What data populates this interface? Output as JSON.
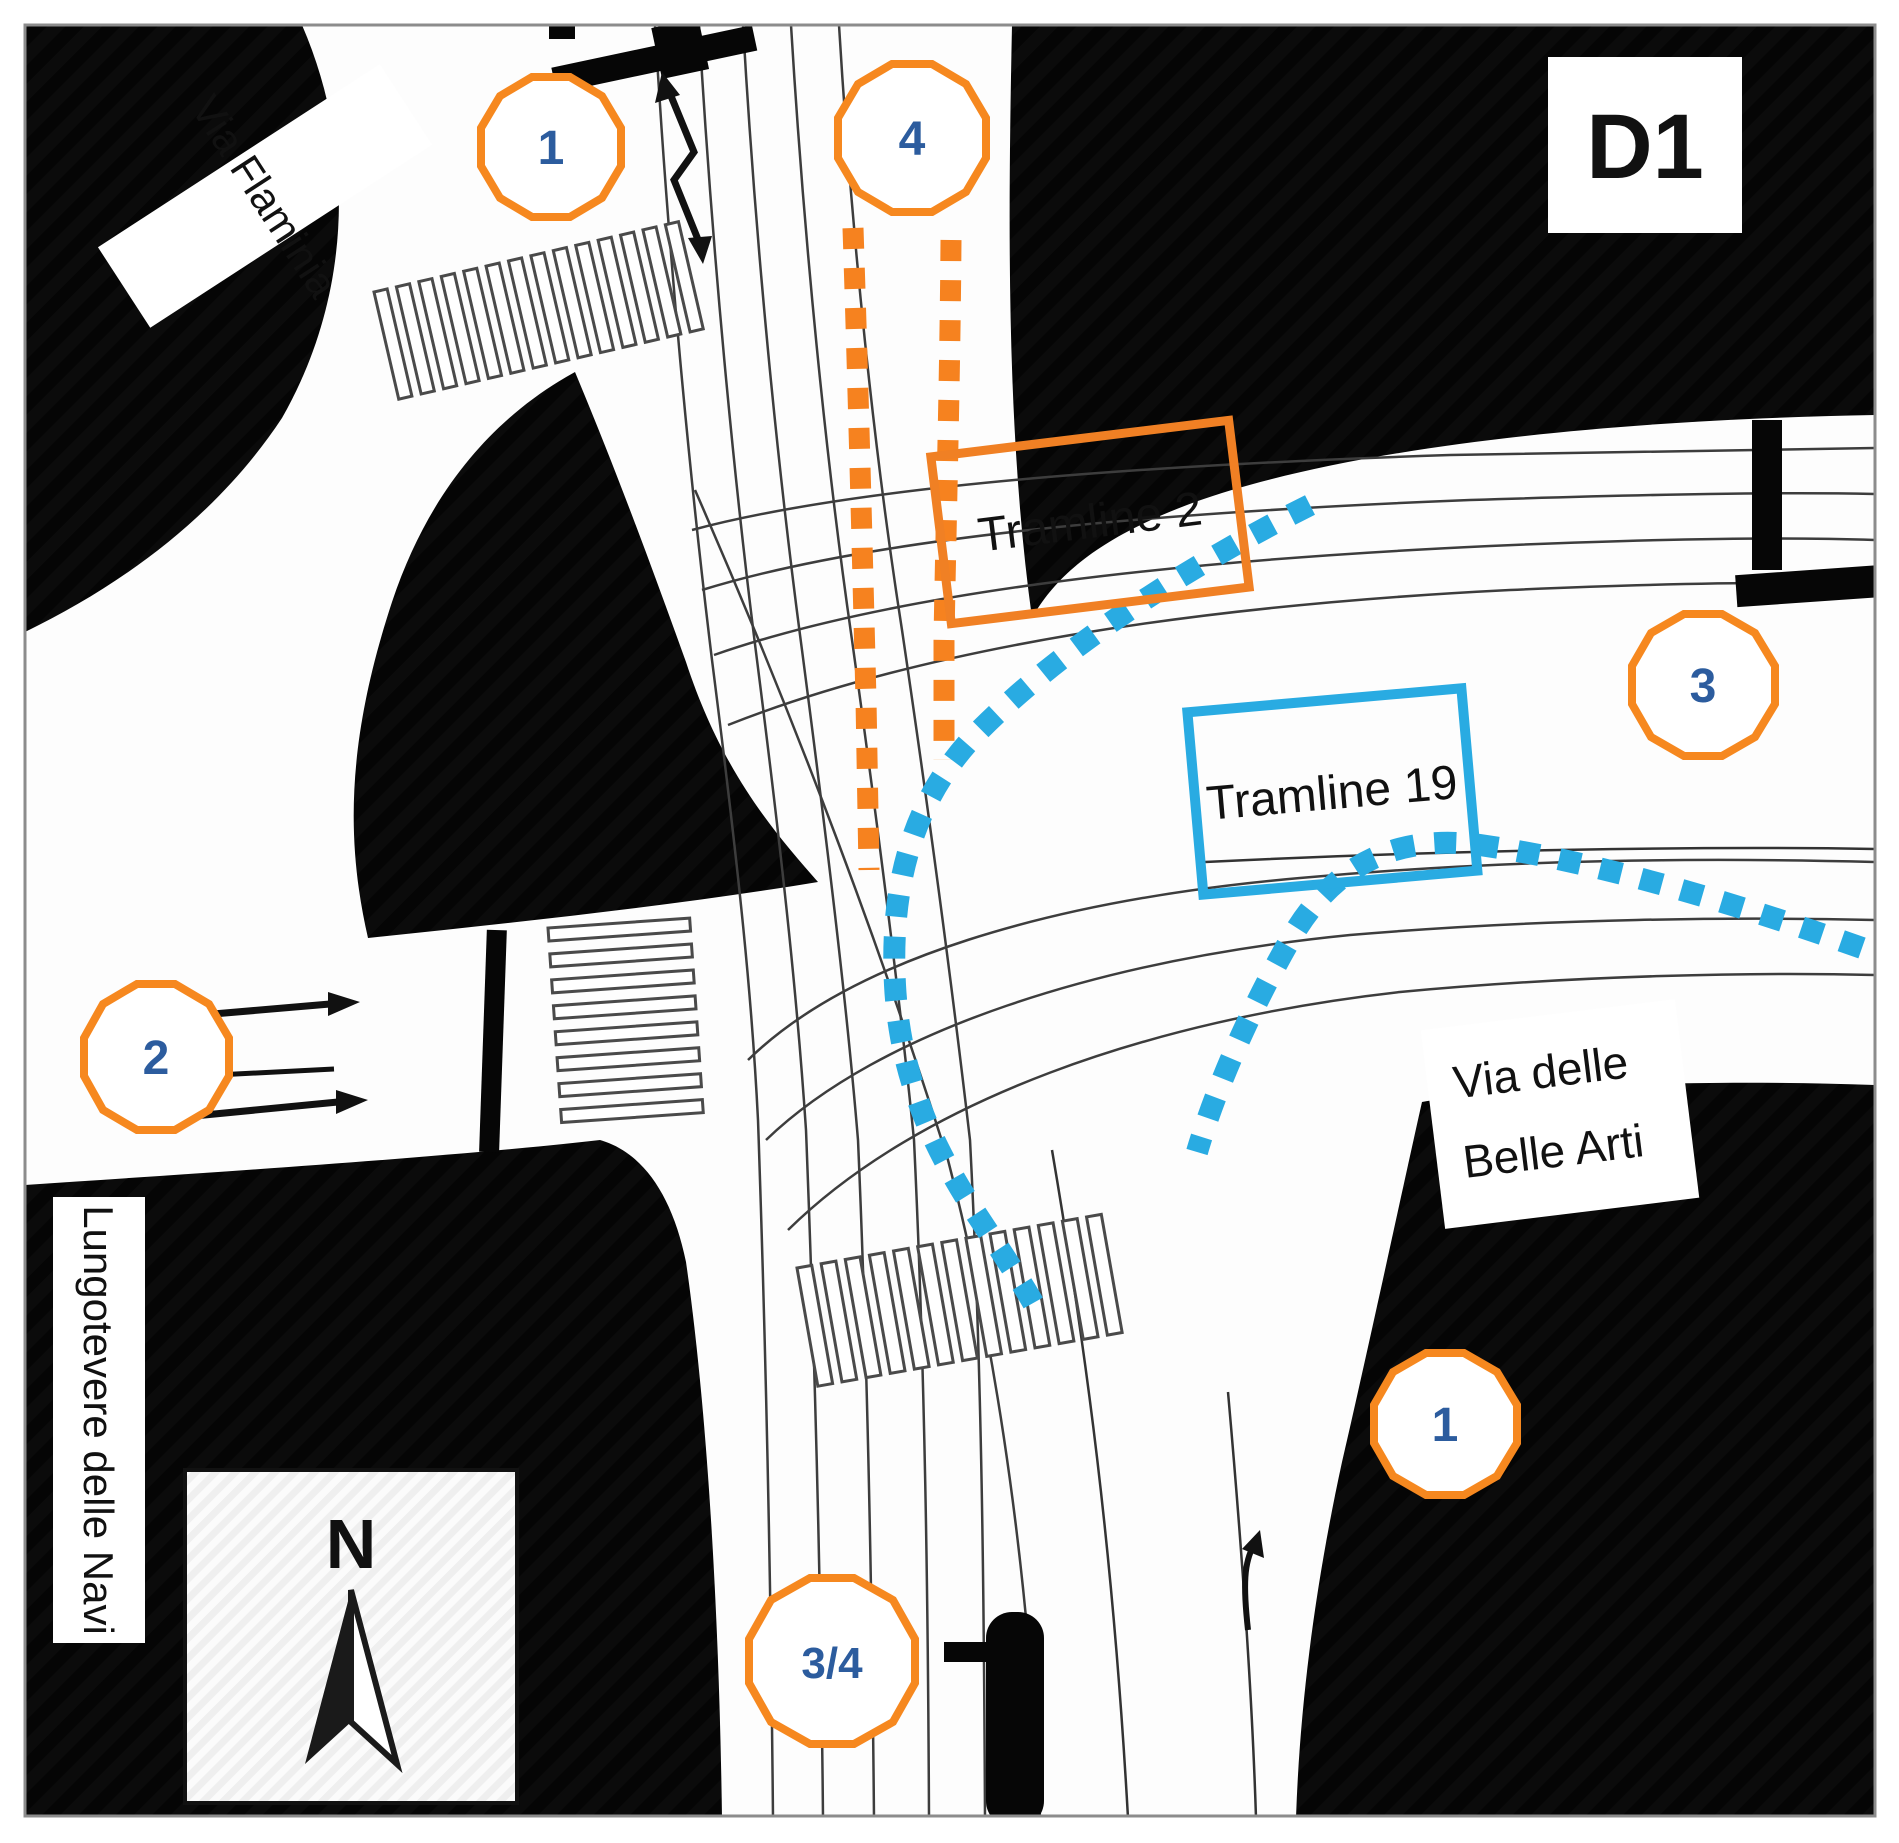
{
  "panel": {
    "id_label": "D1"
  },
  "streets": {
    "via_flaminia": "Via Flaminia",
    "lungotevere": "Lungotevere delle Navi",
    "belle_arti_lines": [
      "Via delle",
      "Belle Arti"
    ]
  },
  "tramlines": {
    "line2": {
      "label": "Tramline 2",
      "color": "#f6821f",
      "style": "orange-dashed-route"
    },
    "line19": {
      "label": "Tramline 19",
      "color": "#29abe2",
      "style": "blue-dashed-route"
    }
  },
  "markers": {
    "flaminia_north": "1",
    "tram_north": "4",
    "lungotevere_west": "2",
    "east": "3",
    "belle_arti_south": "1",
    "tram_south": "3/4"
  },
  "compass": {
    "north_label": "N"
  },
  "colors": {
    "marker_ring": "#f6881f",
    "marker_number": "#2c5c9e",
    "road": "#ffffff",
    "block": "#000000",
    "tram_track": "#3d3d3d"
  }
}
